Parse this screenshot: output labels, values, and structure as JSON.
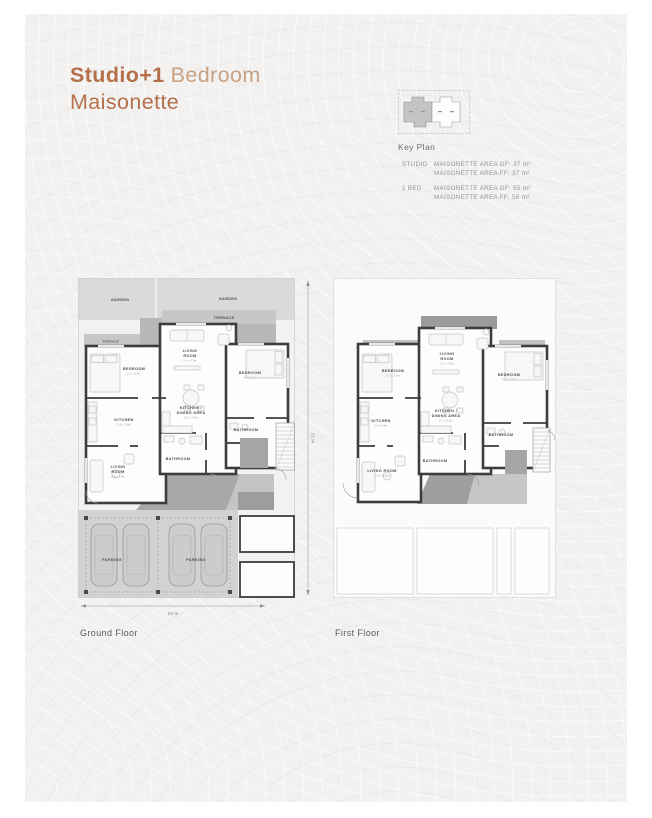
{
  "colors": {
    "accent": "#b56f4a",
    "accent_light": "#c8a183",
    "wall": "#3d3d3b"
  },
  "header": {
    "title_bold": "Studio+1",
    "title_regular": "Bedroom",
    "title_line2": "Maisonette"
  },
  "key_plan": {
    "label": "Key Plan"
  },
  "specs": {
    "rows": [
      {
        "type": "STUDIO",
        "line1": "MAISONETTE AREA GF: 37 m²",
        "line2": "MAISONETTE AREA FF: 37 m²"
      },
      {
        "type": "1 BED",
        "line1": "MAISONETTE AREA GF: 55 m²",
        "line2": "MAISONETTE AREA FF: 56 m²"
      }
    ]
  },
  "ground_floor": {
    "caption": "Ground Floor",
    "dim_width": "14 m",
    "dim_height": "21 m",
    "labels": {
      "garden_left": "GARDEN",
      "garden_right": "GARDEN",
      "terrace_top": "TERRACE",
      "terrace_left": "TERRACE",
      "bedroom_left": "BEDROOM",
      "bedroom_left_dim": "2.7 x 3.0m",
      "living_room_1": "LIVING",
      "living_room_2": "ROOM",
      "living_room_dim": "3.1 x 4.0m",
      "bedroom_right": "BEDROOM",
      "bedroom_right_dim": "4.0 x 2.7m",
      "kitchen": "KITCHEN",
      "kitchen_dim": "2.4 x 2.4m",
      "kitchen_dining_1": "KITCHEN /",
      "kitchen_dining_2": "DINING AREA",
      "kitchen_dining_dim": "2.7 x 4.3m",
      "bathroom_right": "BATHROOM",
      "bathroom_center": "BATHROOM",
      "living_room_bottom_1": "LIVING",
      "living_room_bottom_2": "ROOM",
      "living_room_bottom_dim": "3.4 x 3.4m",
      "parking_left": "PARKING",
      "parking_right": "PARKING"
    }
  },
  "first_floor": {
    "caption": "First Floor",
    "labels": {
      "bedroom_left": "BEDROOM",
      "bedroom_left_dim": "2.7 x 3.0m",
      "living_room_1": "LIVING",
      "living_room_2": "ROOM",
      "living_room_dim": "3.1 x 4.0m",
      "bedroom_right": "BEDROOM",
      "bedroom_right_dim": "4.0 x 2.7m",
      "kitchen": "KITCHEN",
      "kitchen_dim": "2.4 x 2.4m",
      "kitchen_dining_1": "KITCHEN /",
      "kitchen_dining_2": "DINING AREA",
      "kitchen_dining_dim": "2.7 x 4.3m",
      "bathroom_right": "BATHROOM",
      "bathroom_center": "BATHROOM",
      "living_room_bottom": "LIVING ROOM",
      "living_room_bottom_dim": "3.4 x 3.4m"
    }
  }
}
